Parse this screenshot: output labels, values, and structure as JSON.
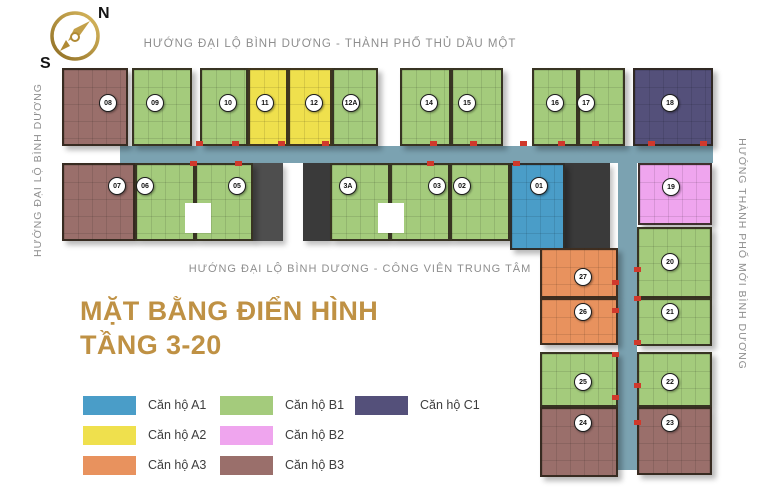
{
  "compass": {
    "north_label": "N",
    "south_label": "S"
  },
  "direction_labels": {
    "top": "HƯỚNG ĐẠI LỘ BÌNH DƯƠNG - THÀNH PHỐ THỦ DẦU MỘT",
    "bottom": "HƯỚNG ĐẠI LỘ BÌNH DƯƠNG - CÔNG VIÊN TRUNG TÂM",
    "left": "HƯỚNG ĐẠI LỘ BÌNH DƯƠNG",
    "right": "HƯỚNG THÀNH PHỐ MỚI BÌNH DƯƠNG"
  },
  "title": {
    "line1": "MẶT BẰNG ĐIỂN HÌNH",
    "line2": "TẦNG 3-20",
    "color": "#bf9144"
  },
  "legend": [
    {
      "type": "A1",
      "label": "Căn hộ A1",
      "color": "#4a9dc8"
    },
    {
      "type": "A2",
      "label": "Căn hộ A2",
      "color": "#efe04d"
    },
    {
      "type": "A3",
      "label": "Căn hộ A3",
      "color": "#e8925e"
    },
    {
      "type": "B1",
      "label": "Căn hộ B1",
      "color": "#a4cb7c"
    },
    {
      "type": "B2",
      "label": "Căn hộ B2",
      "color": "#efa5ee"
    },
    {
      "type": "B3",
      "label": "Căn hộ B3",
      "color": "#9a6f6b"
    },
    {
      "type": "C1",
      "label": "Căn hộ C1",
      "color": "#54507a"
    }
  ],
  "plan": {
    "corridor_color": "#7ba2b1",
    "units": [
      {
        "no": "08",
        "type": "B3",
        "x": 62,
        "y": 68,
        "w": 66,
        "h": 78,
        "bx": 108,
        "by": 103
      },
      {
        "no": "09",
        "type": "B1",
        "x": 132,
        "y": 68,
        "w": 60,
        "h": 78,
        "bx": 155,
        "by": 103
      },
      {
        "no": "10",
        "type": "B1",
        "x": 200,
        "y": 68,
        "w": 48,
        "h": 78,
        "bx": 228,
        "by": 103
      },
      {
        "no": "11",
        "type": "A2",
        "x": 248,
        "y": 68,
        "w": 40,
        "h": 78,
        "bx": 265,
        "by": 103
      },
      {
        "no": "12",
        "type": "A2",
        "x": 288,
        "y": 68,
        "w": 44,
        "h": 78,
        "bx": 314,
        "by": 103
      },
      {
        "no": "12A",
        "type": "B1",
        "x": 332,
        "y": 68,
        "w": 46,
        "h": 78,
        "bx": 351,
        "by": 103
      },
      {
        "no": "14",
        "type": "B1",
        "x": 400,
        "y": 68,
        "w": 51,
        "h": 78,
        "bx": 429,
        "by": 103
      },
      {
        "no": "15",
        "type": "B1",
        "x": 451,
        "y": 68,
        "w": 52,
        "h": 78,
        "bx": 467,
        "by": 103
      },
      {
        "no": "16",
        "type": "B1",
        "x": 532,
        "y": 68,
        "w": 46,
        "h": 78,
        "bx": 555,
        "by": 103
      },
      {
        "no": "17",
        "type": "B1",
        "x": 578,
        "y": 68,
        "w": 47,
        "h": 78,
        "bx": 586,
        "by": 103
      },
      {
        "no": "18",
        "type": "C1",
        "x": 633,
        "y": 68,
        "w": 80,
        "h": 78,
        "bx": 670,
        "by": 103
      },
      {
        "no": "07",
        "type": "B3",
        "x": 62,
        "y": 163,
        "w": 73,
        "h": 78,
        "bx": 117,
        "by": 186
      },
      {
        "no": "06",
        "type": "B1",
        "x": 135,
        "y": 163,
        "w": 60,
        "h": 78,
        "bx": 145,
        "by": 186
      },
      {
        "no": "05",
        "type": "B1",
        "x": 195,
        "y": 163,
        "w": 58,
        "h": 78,
        "bx": 237,
        "by": 186
      },
      {
        "no": "3A",
        "type": "B1",
        "x": 330,
        "y": 163,
        "w": 60,
        "h": 78,
        "bx": 348,
        "by": 186
      },
      {
        "no": "03",
        "type": "B1",
        "x": 390,
        "y": 163,
        "w": 60,
        "h": 78,
        "bx": 437,
        "by": 186
      },
      {
        "no": "02",
        "type": "B1",
        "x": 450,
        "y": 163,
        "w": 60,
        "h": 78,
        "bx": 462,
        "by": 186
      },
      {
        "no": "01",
        "type": "A1",
        "x": 510,
        "y": 163,
        "w": 55,
        "h": 87,
        "bx": 539,
        "by": 186
      },
      {
        "no": "19",
        "type": "B2",
        "x": 638,
        "y": 163,
        "w": 74,
        "h": 62,
        "bx": 671,
        "by": 187
      },
      {
        "no": "27",
        "type": "A3",
        "x": 540,
        "y": 248,
        "w": 78,
        "h": 50,
        "bx": 583,
        "by": 277
      },
      {
        "no": "26",
        "type": "A3",
        "x": 540,
        "y": 298,
        "w": 78,
        "h": 47,
        "bx": 583,
        "by": 312
      },
      {
        "no": "25",
        "type": "B1",
        "x": 540,
        "y": 352,
        "w": 78,
        "h": 55,
        "bx": 583,
        "by": 382
      },
      {
        "no": "24",
        "type": "B3",
        "x": 540,
        "y": 407,
        "w": 78,
        "h": 70,
        "bx": 583,
        "by": 423
      },
      {
        "no": "20",
        "type": "B1",
        "x": 637,
        "y": 227,
        "w": 75,
        "h": 71,
        "bx": 670,
        "by": 262
      },
      {
        "no": "21",
        "type": "B1",
        "x": 637,
        "y": 298,
        "w": 75,
        "h": 48,
        "bx": 670,
        "by": 312
      },
      {
        "no": "22",
        "type": "B1",
        "x": 637,
        "y": 352,
        "w": 75,
        "h": 55,
        "bx": 670,
        "by": 382
      },
      {
        "no": "23",
        "type": "B3",
        "x": 637,
        "y": 407,
        "w": 75,
        "h": 68,
        "bx": 670,
        "by": 423
      }
    ],
    "corridors": [
      {
        "x": 120,
        "y": 146,
        "w": 593,
        "h": 17
      },
      {
        "x": 618,
        "y": 146,
        "w": 19,
        "h": 324
      }
    ],
    "cores": [
      {
        "x": 253,
        "y": 163,
        "w": 30,
        "h": 78,
        "color": "#4e4e4e"
      },
      {
        "x": 303,
        "y": 163,
        "w": 27,
        "h": 78,
        "color": "#3a3a3a"
      },
      {
        "x": 562,
        "y": 163,
        "w": 48,
        "h": 87,
        "color": "#3a3a3a"
      }
    ],
    "lightwells": [
      {
        "x": 185,
        "y": 203,
        "w": 26,
        "h": 30
      },
      {
        "x": 378,
        "y": 203,
        "w": 26,
        "h": 30
      }
    ],
    "door_markers": [
      {
        "x": 196,
        "y": 141
      },
      {
        "x": 232,
        "y": 141
      },
      {
        "x": 278,
        "y": 141
      },
      {
        "x": 322,
        "y": 141
      },
      {
        "x": 430,
        "y": 141
      },
      {
        "x": 470,
        "y": 141
      },
      {
        "x": 520,
        "y": 141
      },
      {
        "x": 558,
        "y": 141
      },
      {
        "x": 592,
        "y": 141
      },
      {
        "x": 648,
        "y": 141
      },
      {
        "x": 700,
        "y": 141
      },
      {
        "x": 190,
        "y": 161
      },
      {
        "x": 235,
        "y": 161
      },
      {
        "x": 427,
        "y": 161
      },
      {
        "x": 513,
        "y": 161
      },
      {
        "x": 612,
        "y": 280
      },
      {
        "x": 612,
        "y": 308
      },
      {
        "x": 612,
        "y": 352
      },
      {
        "x": 612,
        "y": 395
      },
      {
        "x": 634,
        "y": 267
      },
      {
        "x": 634,
        "y": 296
      },
      {
        "x": 634,
        "y": 340
      },
      {
        "x": 634,
        "y": 383
      },
      {
        "x": 634,
        "y": 420
      }
    ]
  }
}
